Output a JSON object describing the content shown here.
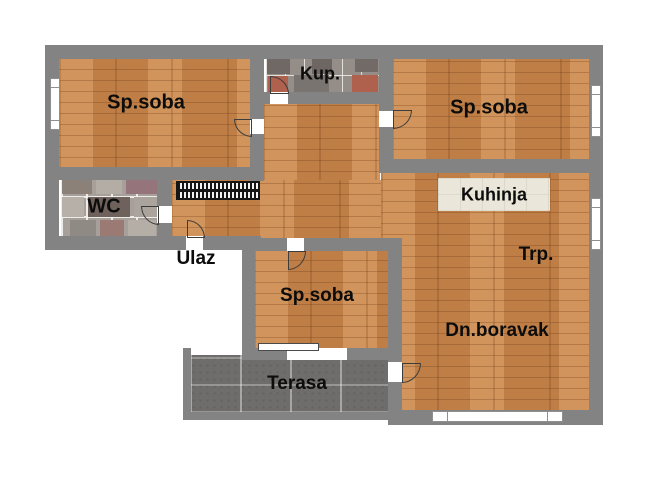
{
  "floorplan": {
    "title": "apartment-floor-plan",
    "rooms": [
      {
        "id": "bedroom-top-left",
        "label": "Sp.soba"
      },
      {
        "id": "bathroom",
        "label": "Kup."
      },
      {
        "id": "bedroom-top-right",
        "label": "Sp.soba"
      },
      {
        "id": "wc",
        "label": "WC"
      },
      {
        "id": "kitchen",
        "label": "Kuhinja"
      },
      {
        "id": "entrance",
        "label": "Ulaz"
      },
      {
        "id": "dining",
        "label": "Trp."
      },
      {
        "id": "bedroom-middle",
        "label": "Sp.soba"
      },
      {
        "id": "living-room",
        "label": "Dn.boravak"
      },
      {
        "id": "terrace",
        "label": "Terasa"
      }
    ],
    "icons": {
      "door": "quarter-arc-swing",
      "window": "double-line-bar",
      "radiator": "striped-coil"
    },
    "colors": {
      "wall": "#838383",
      "wood_floor": "#c8884f",
      "terrace_tile": "#6e6d6b",
      "bathroom_tile": "#948d88",
      "wc_tile": "#a7a09a",
      "kitchen_counter": "#eae6d9",
      "label_text": "#0c0c0c",
      "background": "#ffffff"
    }
  }
}
